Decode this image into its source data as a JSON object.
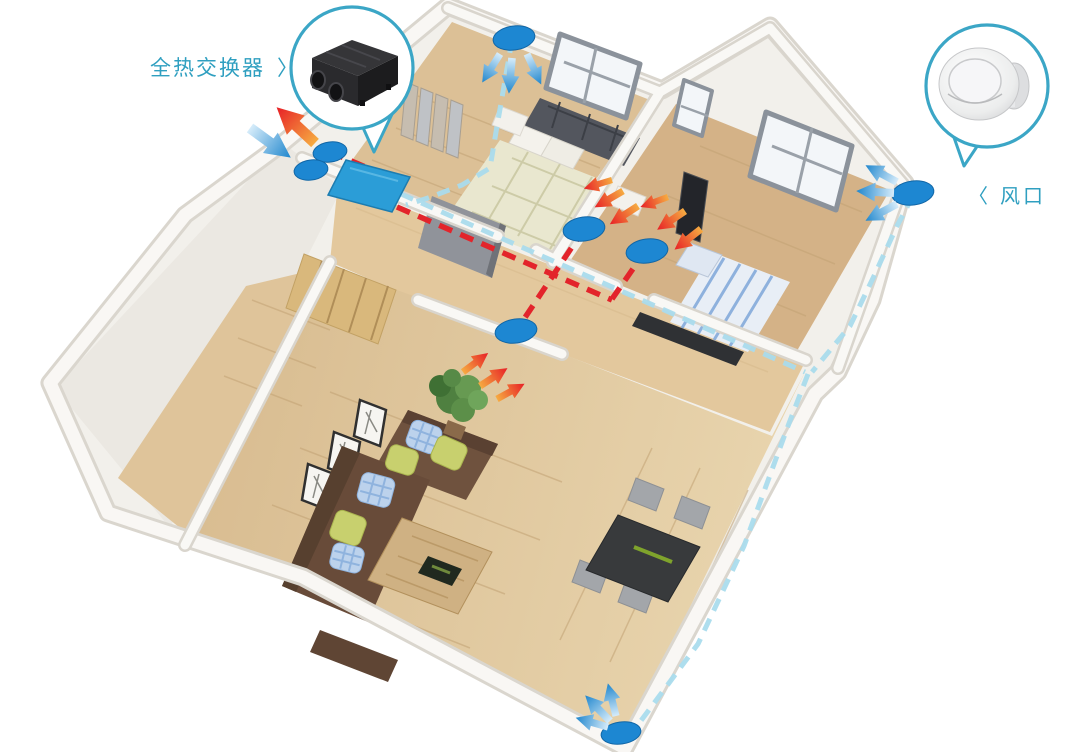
{
  "callouts": {
    "heat_exchanger": {
      "label": "全热交换器",
      "pointer": "〉",
      "device_icon": "heat-recovery-ventilator-unit"
    },
    "air_vent": {
      "pointer": "〈",
      "label": "风口",
      "device_icon": "round-ceiling-diffuser"
    }
  },
  "colors": {
    "label_text": "#2f9fc0",
    "callout_ring": "#3ba6c6",
    "supply_duct": "#aadced",
    "exhaust_duct": "#e3242b",
    "vent_dot": "#1d87d2",
    "unit_panel": "#2b9dd7",
    "supply_arrow_tail": "#d6ecfa",
    "supply_arrow_head": "#1f86cd",
    "exhaust_arrow_tail": "#f6ab41",
    "exhaust_arrow_head": "#e71f26"
  },
  "diagram": {
    "supply_vent_dots": 3,
    "exhaust_vent_dots": 3,
    "outdoor_port_dots": 2
  }
}
